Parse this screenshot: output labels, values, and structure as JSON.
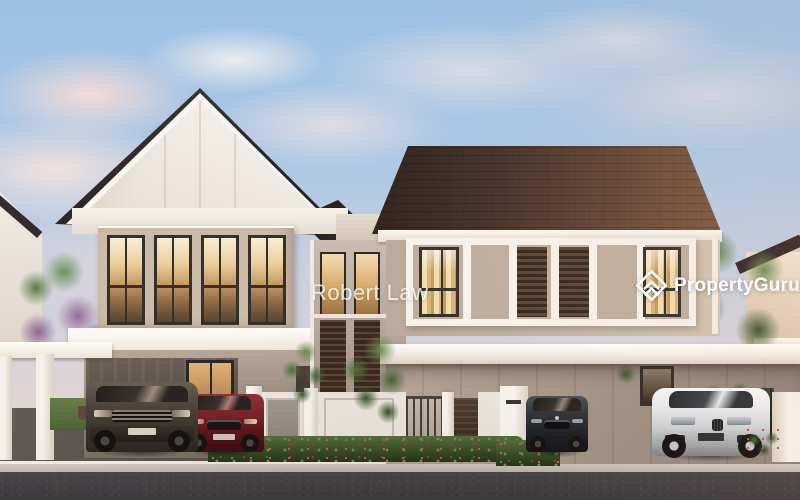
{
  "overlay": {
    "agent_watermark": "Robert Law",
    "brand": {
      "name": "PropertyGuru",
      "icon": "propertyguru-house-icon",
      "color": "#ffffff"
    }
  },
  "scene": {
    "palette": {
      "sky-top": "#9cc0e4",
      "sky-horizon": "#ecdcd2",
      "roof-dark": "#2b2326",
      "roof-brown": "#6a4c3b",
      "wall-white": "#f6f1ea",
      "wall-beige": "#c6b5a5",
      "wall-shadow": "#8f8278",
      "window-glow": "#e0b077",
      "louver-brown": "#38291f",
      "foliage-green": "#55703f",
      "foliage-purple": "#966b9b",
      "hedge-red": "#d4584b",
      "car-suv": "#4e443c",
      "car-red": "#7a2329",
      "car-dark": "#34363c",
      "car-white": "#e9ebed",
      "asphalt": "#534e4a",
      "curb": "#d2cbc3",
      "road": "#3e3b3f"
    }
  }
}
